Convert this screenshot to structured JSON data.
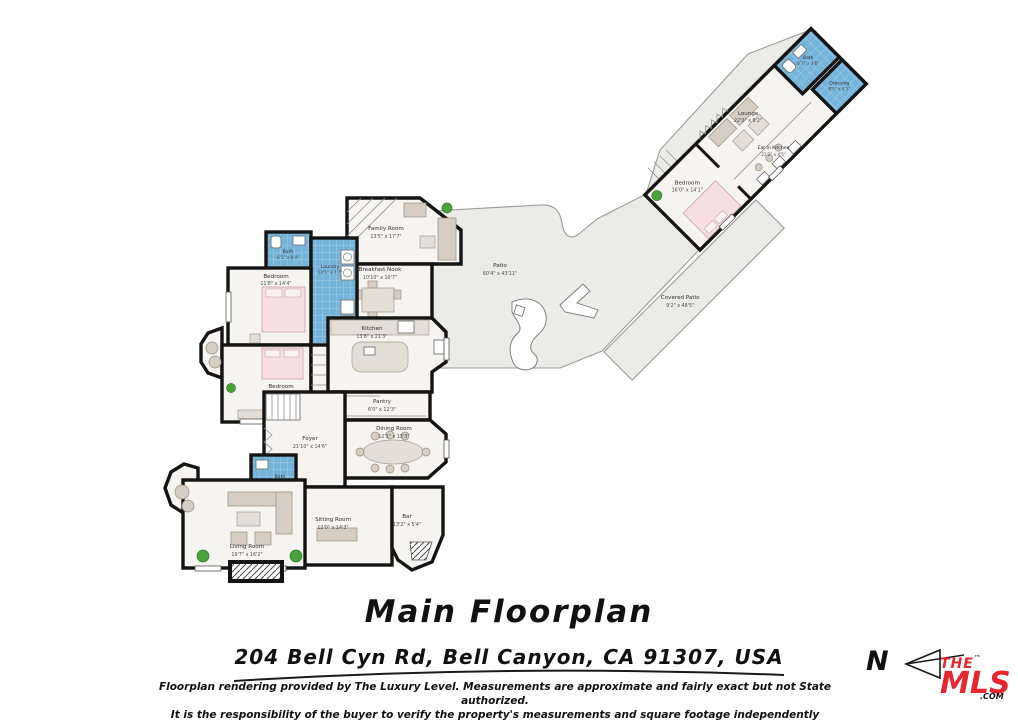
{
  "title": "Main Floorplan",
  "address": "204 Bell Cyn Rd, Bell Canyon, CA 91307, USA",
  "disclaimer_line1": "Floorplan rendering provided by The Luxury Level. Measurements are approximate and fairly exact but not State authorized.",
  "disclaimer_line2": "It is the responsibility of the buyer to verify the property's measurements and square footage independently",
  "compass": {
    "label": "N"
  },
  "logo": {
    "the": "THE",
    "mls": "MLS",
    "com": ".COM",
    "tm": "™",
    "color": "#e8262d"
  },
  "colors": {
    "wall": "#141414",
    "floor": "#f6f4f1",
    "tile_blue": "#74b4da",
    "patio_gray": "#ebebe8",
    "bed_pink": "#f6dee1",
    "furniture_tan": "#d6cec2",
    "plant_green": "#49a33a"
  },
  "rooms": [
    {
      "name": "Family Room",
      "dims": "13'5\" x 17'7\""
    },
    {
      "name": "Breakfast Nook",
      "dims": "10'10\" x 10'7\""
    },
    {
      "name": "Bath",
      "dims": "6'1\" x 8'4\""
    },
    {
      "name": "Laundry",
      "dims": "14'5\" x 7'7\""
    },
    {
      "name": "Bedroom",
      "dims": "11'8\" x 14'4\""
    },
    {
      "name": "Bedroom",
      "dims": "13'10\" x 14'3\""
    },
    {
      "name": "Kitchen",
      "dims": "13'8\" x 21'3\""
    },
    {
      "name": "Pantry",
      "dims": "6'0\" x 12'3\""
    },
    {
      "name": "Dining Room",
      "dims": "12'1\" x 15'3\""
    },
    {
      "name": "Foyer",
      "dims": "21'10\" x 14'6\""
    },
    {
      "name": "Bath",
      "dims": "4'2\" x 4'11\""
    },
    {
      "name": "Sitting Room",
      "dims": "12'0\" x 14'3\""
    },
    {
      "name": "Bar",
      "dims": "13'2\" x 5'4\""
    },
    {
      "name": "Living Room",
      "dims": "19'7\" x 16'2\""
    },
    {
      "name": "Patio",
      "dims": "60'4\" x 43'11\""
    },
    {
      "name": "Covered Patio",
      "dims": "9'2\" x 48'5\""
    },
    {
      "name": "Bedroom",
      "dims": "16'0\" x 14'1\""
    },
    {
      "name": "Eat in Kitchen",
      "dims": "21'2\" x 4'5\""
    },
    {
      "name": "Lounge",
      "dims": "22'0\" x 9'2\""
    },
    {
      "name": "Bath",
      "dims": "8'7\" x 4'6\""
    },
    {
      "name": "Dressing",
      "dims": "4'9\" x 4'5\""
    }
  ]
}
